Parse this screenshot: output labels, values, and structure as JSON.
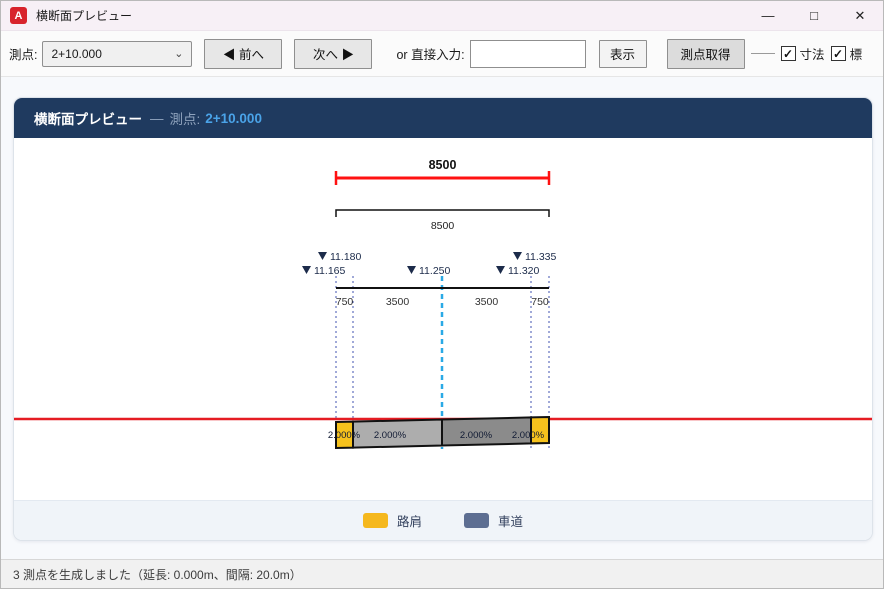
{
  "window": {
    "icon_letter": "A",
    "title": "横断面プレビュー",
    "controls": {
      "minimize": "—",
      "maximize": "□",
      "close": "✕"
    }
  },
  "toolbar": {
    "station_label": "測点:",
    "station_value": "2+10.000",
    "prev_label": "◀ 前へ",
    "next_label": "次へ ▶",
    "direct_input_label": "or 直接入力:",
    "direct_input_value": "",
    "show_label": "表示",
    "get_station_label": "測点取得",
    "checkbox_dimension_label": "寸法",
    "checkbox_elevation_label": "標",
    "checkbox_dimension_checked": "✓",
    "checkbox_elevation_checked": "✓"
  },
  "panel": {
    "header_title": "横断面プレビュー",
    "header_sep": "—",
    "header_station_label": "測点:",
    "header_station_value": "2+10.000"
  },
  "drawing": {
    "dim_total_red": "8500",
    "dim_total_black": "8500",
    "elevation_markers": [
      {
        "anchor": "left_edge",
        "row": 2,
        "label": "11.165"
      },
      {
        "anchor": "left_lane",
        "row": 1,
        "label": "11.180"
      },
      {
        "anchor": "center",
        "row": 2,
        "label": "11.250"
      },
      {
        "anchor": "right_lane",
        "row": 2,
        "label": "11.320"
      },
      {
        "anchor": "right_edge",
        "row": 1,
        "label": "11.335"
      }
    ],
    "widths": [
      "750",
      "3500",
      "3500",
      "750"
    ],
    "slopes": [
      "2.000%",
      "2.000%",
      "2.000%",
      "2.000%"
    ],
    "colors": {
      "shoulder": "#f6c21d",
      "lane_left": "#adadad",
      "lane_right": "#8b8b8b",
      "outline": "#111111",
      "dim_line": "#ff1111",
      "datum_line": "#e51c23",
      "centerline": "#2aa9e6",
      "guide_line": "#4053b0",
      "text": "#1c2b4a"
    }
  },
  "legend": {
    "items": [
      {
        "label": "路肩",
        "color": "#f5b81e"
      },
      {
        "label": "車道",
        "color": "#5d6e92"
      }
    ]
  },
  "statusbar": {
    "text": "3 測点を生成しました（延長: 0.000m、間隔: 20.0m）"
  }
}
